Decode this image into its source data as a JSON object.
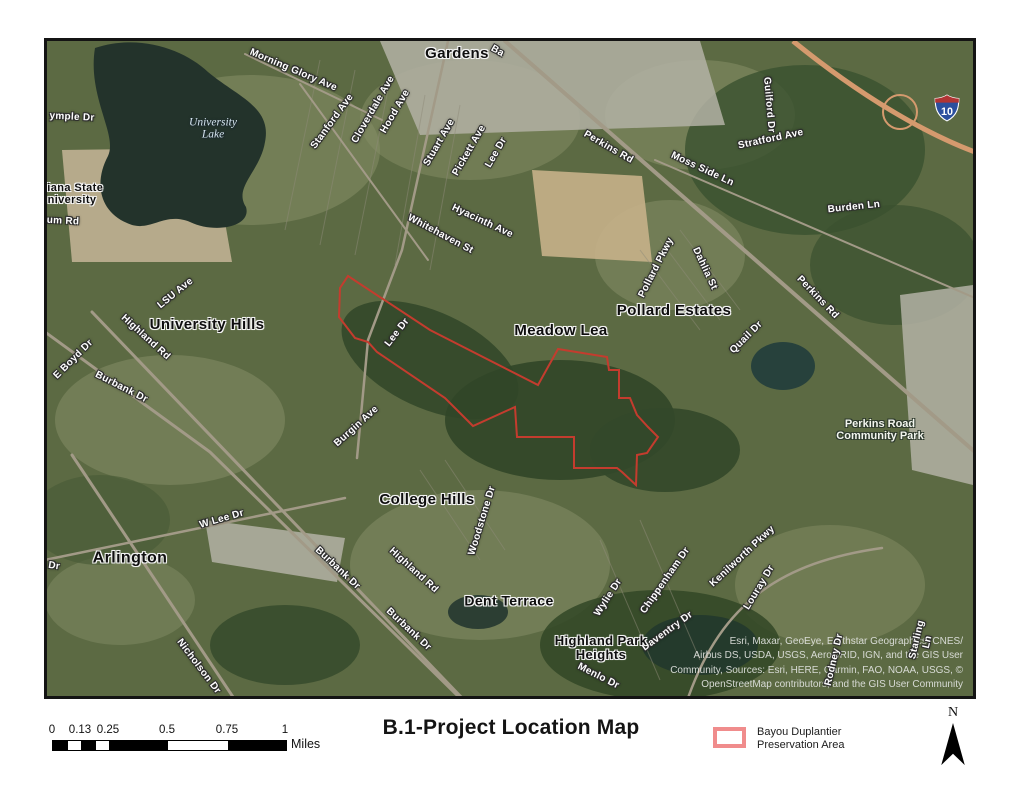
{
  "map": {
    "shield": {
      "route": "10"
    },
    "labels": [
      {
        "kind": "street",
        "text": "Morning Glory Ave",
        "x": 293,
        "y": 71,
        "rot": 23,
        "size": 10
      },
      {
        "kind": "street",
        "text": "Stanford Ave",
        "x": 333,
        "y": 122,
        "rot": -54,
        "size": 10
      },
      {
        "kind": "street",
        "text": "Cloverdale Ave",
        "x": 374,
        "y": 110,
        "rot": -60,
        "size": 10
      },
      {
        "kind": "street",
        "text": "Hood Ave",
        "x": 396,
        "y": 112,
        "rot": -60,
        "size": 10
      },
      {
        "kind": "street",
        "text": "Stuart Ave",
        "x": 440,
        "y": 143,
        "rot": -60,
        "size": 10
      },
      {
        "kind": "street",
        "text": "Pickett Ave",
        "x": 470,
        "y": 151,
        "rot": -60,
        "size": 10
      },
      {
        "kind": "street",
        "text": "Lee Dr",
        "x": 497,
        "y": 153,
        "rot": -60,
        "size": 10
      },
      {
        "kind": "street",
        "text": "Perkins Rd",
        "x": 608,
        "y": 148,
        "rot": 30,
        "size": 10
      },
      {
        "kind": "street",
        "text": "Moss Side Ln",
        "x": 702,
        "y": 170,
        "rot": 25,
        "size": 10
      },
      {
        "kind": "street",
        "text": "Stratford Ave",
        "x": 771,
        "y": 140,
        "rot": -12,
        "size": 10
      },
      {
        "kind": "street",
        "text": "Guilford Dr",
        "x": 768,
        "y": 105,
        "rot": 85,
        "size": 10
      },
      {
        "kind": "street",
        "text": "Burden Ln",
        "x": 854,
        "y": 208,
        "rot": -6,
        "size": 10
      },
      {
        "kind": "street",
        "text": "Hyacinth Ave",
        "x": 482,
        "y": 222,
        "rot": 25,
        "size": 10
      },
      {
        "kind": "street",
        "text": "Whitehaven St",
        "x": 440,
        "y": 235,
        "rot": 28,
        "size": 10
      },
      {
        "kind": "street",
        "text": "LSU Ave",
        "x": 176,
        "y": 294,
        "rot": -39,
        "size": 10
      },
      {
        "kind": "street",
        "text": "Highland Rd",
        "x": 145,
        "y": 338,
        "rot": 42,
        "size": 10
      },
      {
        "kind": "street",
        "text": "E Boyd Dr",
        "x": 74,
        "y": 360,
        "rot": -45,
        "size": 10
      },
      {
        "kind": "street",
        "text": "Burbank Dr",
        "x": 121,
        "y": 388,
        "rot": 27,
        "size": 10
      },
      {
        "kind": "street",
        "text": "Burgin Ave",
        "x": 357,
        "y": 427,
        "rot": -42,
        "size": 10
      },
      {
        "kind": "street",
        "text": "Lee Dr",
        "x": 398,
        "y": 333,
        "rot": -52,
        "size": 10
      },
      {
        "kind": "street",
        "text": "Pollard Pkwy",
        "x": 657,
        "y": 268,
        "rot": -63,
        "size": 10
      },
      {
        "kind": "street",
        "text": "Dahlia St",
        "x": 704,
        "y": 269,
        "rot": 65,
        "size": 10
      },
      {
        "kind": "street",
        "text": "Quail Dr",
        "x": 747,
        "y": 338,
        "rot": -45,
        "size": 10
      },
      {
        "kind": "street",
        "text": "Perkins Rd",
        "x": 817,
        "y": 298,
        "rot": 46,
        "size": 10
      },
      {
        "kind": "street",
        "text": "W Lee Dr",
        "x": 222,
        "y": 520,
        "rot": -16,
        "size": 10
      },
      {
        "kind": "street",
        "text": "Burbank Dr",
        "x": 337,
        "y": 569,
        "rot": 43,
        "size": 10
      },
      {
        "kind": "street",
        "text": "Nicholson Dr",
        "x": 198,
        "y": 667,
        "rot": 53,
        "size": 10
      },
      {
        "kind": "street",
        "text": "Highland Rd",
        "x": 413,
        "y": 571,
        "rot": 42,
        "size": 10
      },
      {
        "kind": "street",
        "text": "Burbank Dr",
        "x": 408,
        "y": 630,
        "rot": 43,
        "size": 10
      },
      {
        "kind": "street",
        "text": "Woodstone Dr",
        "x": 483,
        "y": 521,
        "rot": -73,
        "size": 10
      },
      {
        "kind": "street",
        "text": "Wylie Dr",
        "x": 609,
        "y": 598,
        "rot": -57,
        "size": 10
      },
      {
        "kind": "street",
        "text": "Chippenham Dr",
        "x": 666,
        "y": 581,
        "rot": -55,
        "size": 10
      },
      {
        "kind": "street",
        "text": "Kenilworth Pkwy",
        "x": 743,
        "y": 557,
        "rot": -43,
        "size": 10
      },
      {
        "kind": "street",
        "text": "Louray Dr",
        "x": 760,
        "y": 588,
        "rot": -59,
        "size": 10
      },
      {
        "kind": "street",
        "text": "Daventry Dr",
        "x": 668,
        "y": 632,
        "rot": -36,
        "size": 10
      },
      {
        "kind": "street",
        "text": "Rodney Dr",
        "x": 835,
        "y": 660,
        "rot": -77,
        "size": 10
      },
      {
        "kind": "street",
        "text": "Starling Ln",
        "x": 923,
        "y": 641,
        "rot": -77,
        "size": 10
      },
      {
        "kind": "street",
        "text": "Menlo Dr",
        "x": 598,
        "y": 677,
        "rot": 27,
        "size": 10
      },
      {
        "kind": "street",
        "text": "ymple Dr",
        "x": 72,
        "y": 118,
        "rot": 3,
        "size": 10
      },
      {
        "kind": "street",
        "text": "um Rd",
        "x": 63,
        "y": 222,
        "rot": 3,
        "size": 10
      },
      {
        "kind": "street",
        "text": "Dr",
        "x": 54,
        "y": 567,
        "rot": 8,
        "size": 10
      },
      {
        "kind": "street",
        "text": "Ba",
        "x": 497,
        "y": 52,
        "rot": 30,
        "size": 10
      },
      {
        "kind": "place",
        "text": "Gardens",
        "x": 457,
        "y": 54,
        "rot": 0,
        "size": 15
      },
      {
        "kind": "place",
        "text": "University Hills",
        "x": 207,
        "y": 325,
        "rot": 0,
        "size": 15
      },
      {
        "kind": "place",
        "text": "Meadow Lea",
        "x": 561,
        "y": 331,
        "rot": 0,
        "size": 15
      },
      {
        "kind": "place",
        "text": "Pollard Estates",
        "x": 674,
        "y": 311,
        "rot": 0,
        "size": 15
      },
      {
        "kind": "place",
        "text": "College Hills",
        "x": 427,
        "y": 500,
        "rot": 0,
        "size": 15
      },
      {
        "kind": "place",
        "text": "Arlington",
        "x": 130,
        "y": 558,
        "rot": 0,
        "size": 16
      },
      {
        "kind": "place",
        "text": "Dent Terrace",
        "x": 509,
        "y": 601,
        "rot": 0,
        "size": 14
      },
      {
        "kind": "place",
        "text": "Highland Park\nHeights",
        "x": 601,
        "y": 648,
        "rot": 0,
        "size": 13
      },
      {
        "kind": "place",
        "text": "siana State\nniversity",
        "x": 72,
        "y": 195,
        "rot": 0,
        "size": 11
      },
      {
        "kind": "water",
        "text": "University\nLake",
        "x": 213,
        "y": 129,
        "rot": 0,
        "size": 11.5
      },
      {
        "kind": "park",
        "text": "Perkins Road\nCommunity Park",
        "x": 880,
        "y": 431,
        "rot": 0,
        "size": 11
      }
    ],
    "attribution": [
      "Esri, Maxar, GeoEye, Earthstar Geographics, CNES/",
      "Airbus DS, USDA, USGS, AeroGRID, IGN, and the GIS User",
      "Community, Sources: Esri, HERE, Garmin, FAO, NOAA, USGS, ©",
      "OpenStreetMap contributors, and the GIS User Community"
    ]
  },
  "preservation_area": {
    "name": "Bayou Duplantier Preservation Area",
    "outline_color": "#c43c2e",
    "points": "348,276 430,330 538,385 558,349 607,357 609,370 619,370 619,398 630,398 637,415 648,427 658,437 647,453 637,455 636,485 622,472 617,468 574,468 574,437 517,437 515,407 473,426 445,398 377,352 368,342 355,338 339,317 340,288"
  },
  "footer": {
    "title": "B.1-Project Location Map",
    "scale_bar": {
      "unit": "Miles",
      "ticks": [
        {
          "x": 52,
          "label": "0"
        },
        {
          "x": 80,
          "label": "0.13"
        },
        {
          "x": 108,
          "label": "0.25"
        },
        {
          "x": 167,
          "label": "0.5"
        },
        {
          "x": 227,
          "label": "0.75"
        },
        {
          "x": 285,
          "label": "1"
        }
      ],
      "segments": [
        {
          "x": 52,
          "w": 15,
          "f": "#000000"
        },
        {
          "x": 67,
          "w": 13,
          "f": "#ffffff"
        },
        {
          "x": 80,
          "w": 15,
          "f": "#000000"
        },
        {
          "x": 95,
          "w": 13,
          "f": "#ffffff"
        },
        {
          "x": 108,
          "w": 59,
          "f": "#000000"
        },
        {
          "x": 167,
          "w": 60,
          "f": "#ffffff"
        },
        {
          "x": 227,
          "w": 58,
          "f": "#000000"
        }
      ]
    },
    "legend": {
      "swatch_color": "#f08c8c",
      "label": "Bayou Duplantier\nPreservation Area"
    },
    "north": {
      "label": "N"
    }
  }
}
